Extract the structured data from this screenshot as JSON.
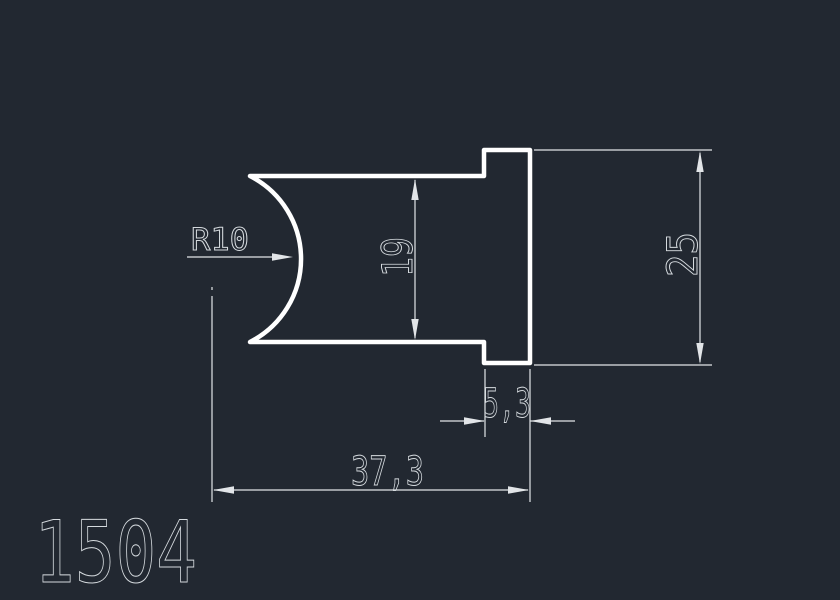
{
  "colors": {
    "background": "#222831",
    "line": "#ffffff",
    "dim": "#e2e5e8",
    "text": "#d5dade"
  },
  "drawing": {
    "part_number": "1504",
    "annotations": {
      "radius": "R10",
      "inner_height": "19",
      "overall_height": "25",
      "flange_thickness": "5,3",
      "overall_width": "37,3"
    }
  }
}
